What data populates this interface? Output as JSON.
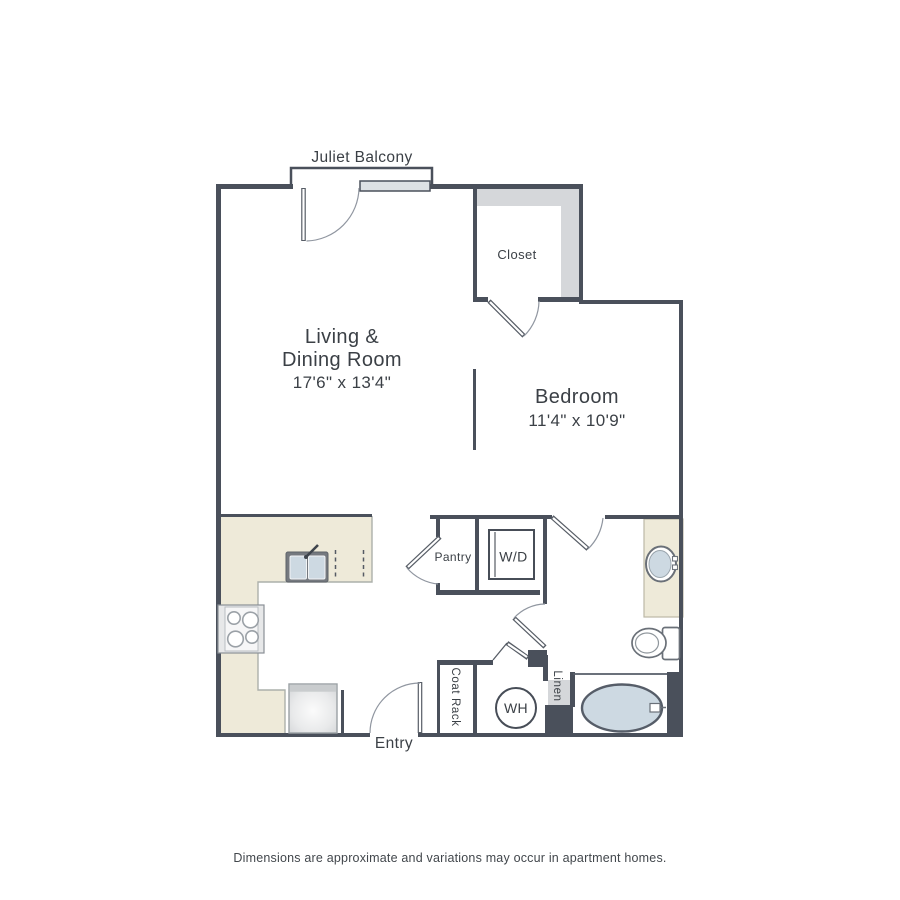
{
  "colors": {
    "wall": "#4a505b",
    "counter": "#eeead9",
    "shelf_gray": "#d5d7da",
    "fixture_blue": "#cdd9e2",
    "window_fill": "#dde1e4",
    "text": "#3b4046"
  },
  "labels": {
    "juliet_balcony": "Juliet Balcony",
    "closet": "Closet",
    "pantry": "Pantry",
    "washer_dryer": "W/D",
    "water_heater": "WH",
    "coat_rack": "Coat Rack",
    "linen": "Linen",
    "entry": "Entry"
  },
  "rooms": {
    "living_dining": {
      "name_line1": "Living &",
      "name_line2": "Dining Room",
      "dimensions": "17'6\" x 13'4\""
    },
    "bedroom": {
      "name": "Bedroom",
      "dimensions": "11'4\" x 10'9\""
    }
  },
  "footer": {
    "disclaimer": "Dimensions are approximate and variations may occur in apartment homes."
  }
}
